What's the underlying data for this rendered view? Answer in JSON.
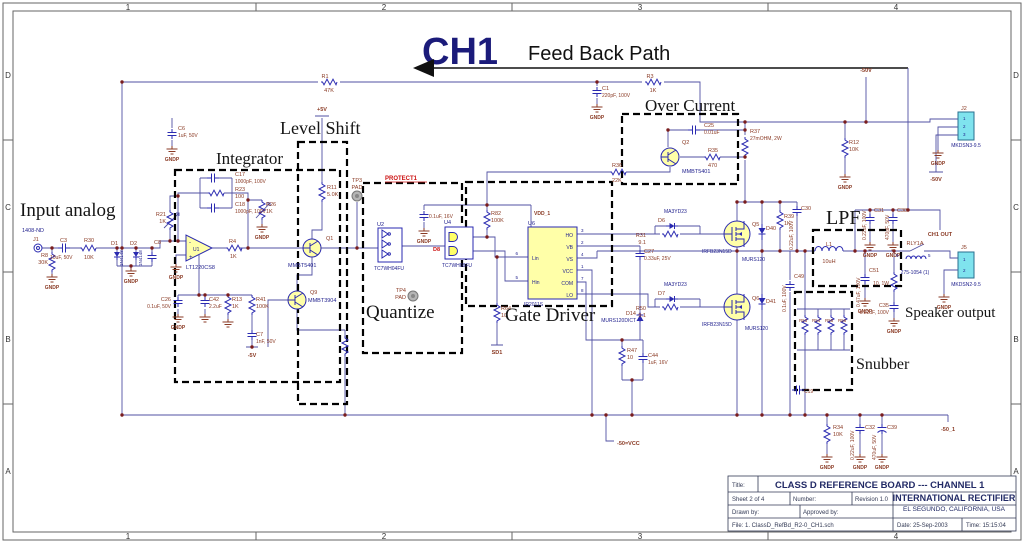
{
  "header": {
    "ch": "CH1",
    "path_label": "Feed Back Path"
  },
  "colors": {
    "component_fill": "#ffffa8",
    "connector_fill": "#7fe3ee",
    "wire": "#5151a3",
    "junction": "#7a1d1d",
    "label_brown": "#8a3a24",
    "label_navy": "#22228e"
  },
  "gnd_label": "GNDP",
  "zones": {
    "cols": [
      "1",
      "2",
      "3",
      "4"
    ],
    "rows": [
      "D",
      "C",
      "B",
      "A"
    ]
  },
  "title_block": {
    "title_label": "Title:",
    "title": "CLASS D REFERENCE BOARD --- CHANNEL 1",
    "sheet": "Sheet  2    of   4",
    "number_label": "Number:",
    "revision": "Revision 1.0",
    "company": "INTERNATIONAL RECTIFIER",
    "address": "EL SEGUNDO, CALIFORNIA, USA",
    "drawn_by": "Drawn by:",
    "approved_by": "Approved by:",
    "file": "File:   1. ClassD_RefBd_R2-0_CH1.sch",
    "date": "Date:  25-Sep-2003",
    "time": "Time:  15:15:04"
  },
  "sections": [
    {
      "id": "input-analog",
      "label": "Input analog",
      "x": 20,
      "y": 216,
      "size": 19
    },
    {
      "id": "integrator",
      "label": "Integrator",
      "x": 216,
      "y": 164,
      "size": 17
    },
    {
      "id": "level-shift",
      "label": "Level Shift",
      "x": 280,
      "y": 134,
      "size": 18
    },
    {
      "id": "quantize",
      "label": "Quantize",
      "x": 366,
      "y": 318,
      "size": 19
    },
    {
      "id": "gate-driver",
      "label": "Gate Driver",
      "x": 505,
      "y": 321,
      "size": 19
    },
    {
      "id": "over-current",
      "label": "Over Current",
      "x": 645,
      "y": 111,
      "size": 17
    },
    {
      "id": "lpf",
      "label": "LPF",
      "x": 826,
      "y": 224,
      "size": 20
    },
    {
      "id": "speaker-output",
      "label": "Speaker output",
      "x": 905,
      "y": 317,
      "size": 15
    },
    {
      "id": "snubber",
      "label": "Snubber",
      "x": 856,
      "y": 369,
      "size": 16
    }
  ],
  "labels": [
    {
      "x": 22,
      "y": 232,
      "t": "1408-ND",
      "c": "part"
    },
    {
      "x": 33,
      "y": 241,
      "t": "J1"
    },
    {
      "x": 48,
      "y": 257,
      "t": "R8",
      "a": "end"
    },
    {
      "x": 48,
      "y": 264,
      "t": "30K",
      "a": "end"
    },
    {
      "x": 60,
      "y": 242,
      "t": "C3"
    },
    {
      "x": 50,
      "y": 259,
      "t": "10uF, 50V",
      "s": 5
    },
    {
      "x": 84,
      "y": 242,
      "t": "R30"
    },
    {
      "x": 84,
      "y": 259,
      "t": "10K"
    },
    {
      "x": 111,
      "y": 245,
      "t": "D1"
    },
    {
      "x": 130,
      "y": 245,
      "t": "D2"
    },
    {
      "x": 123,
      "y": 266,
      "t": "1N4148",
      "c": "part",
      "s": 4.5,
      "r": -90
    },
    {
      "x": 142,
      "y": 266,
      "t": "1N4148",
      "c": "part",
      "s": 4.5,
      "r": -90
    },
    {
      "x": 154,
      "y": 244,
      "t": "C8"
    },
    {
      "x": 178,
      "y": 130,
      "t": "C6"
    },
    {
      "x": 178,
      "y": 137,
      "t": "1uF, 50V",
      "s": 5
    },
    {
      "x": 166,
      "y": 216,
      "t": "R21",
      "a": "end"
    },
    {
      "x": 166,
      "y": 223,
      "t": "1K",
      "a": "end"
    },
    {
      "x": 235,
      "y": 176,
      "t": "C17"
    },
    {
      "x": 235,
      "y": 183,
      "t": "1000pF, 100V",
      "s": 5
    },
    {
      "x": 235,
      "y": 191,
      "t": "R23"
    },
    {
      "x": 235,
      "y": 198,
      "t": "100"
    },
    {
      "x": 235,
      "y": 206,
      "t": "C18"
    },
    {
      "x": 235,
      "y": 213,
      "t": "1000pF, 100V",
      "s": 5
    },
    {
      "x": 266,
      "y": 206,
      "t": "R26"
    },
    {
      "x": 266,
      "y": 213,
      "t": "1K"
    },
    {
      "x": 193,
      "y": 251,
      "t": "U1",
      "c": "part",
      "s": 5
    },
    {
      "x": 186,
      "y": 269,
      "t": "LT1220CS8",
      "c": "part"
    },
    {
      "x": 189,
      "y": 244,
      "t": "-",
      "c": "part",
      "s": 6
    },
    {
      "x": 189,
      "y": 259,
      "t": "+",
      "c": "part",
      "s": 6
    },
    {
      "x": 229,
      "y": 243,
      "t": "R4"
    },
    {
      "x": 230,
      "y": 258,
      "t": "1K"
    },
    {
      "x": 171,
      "y": 301,
      "t": "C26",
      "a": "end"
    },
    {
      "x": 171,
      "y": 308,
      "t": "0.1uF, 50V",
      "a": "end",
      "s": 5
    },
    {
      "x": 209,
      "y": 301,
      "t": "C42"
    },
    {
      "x": 209,
      "y": 308,
      "t": "2.2uF",
      "s": 5
    },
    {
      "x": 232,
      "y": 301,
      "t": "R13"
    },
    {
      "x": 232,
      "y": 308,
      "t": "1K"
    },
    {
      "x": 256,
      "y": 301,
      "t": "R41"
    },
    {
      "x": 256,
      "y": 308,
      "t": "100K"
    },
    {
      "x": 256,
      "y": 336,
      "t": "C7"
    },
    {
      "x": 256,
      "y": 343,
      "t": "1nF, 50V",
      "s": 5
    },
    {
      "x": 252,
      "y": 357,
      "t": "-5V",
      "c": "pwr",
      "a": "middle"
    },
    {
      "x": 322,
      "y": 111,
      "t": "+5V",
      "c": "pwr",
      "a": "middle"
    },
    {
      "x": 327,
      "y": 189,
      "t": "R11"
    },
    {
      "x": 327,
      "y": 196,
      "t": "5.0K"
    },
    {
      "x": 326,
      "y": 240,
      "t": "Q1"
    },
    {
      "x": 288,
      "y": 267,
      "t": "MMBT5401",
      "c": "part"
    },
    {
      "x": 310,
      "y": 294,
      "t": "Q9"
    },
    {
      "x": 308,
      "y": 302,
      "t": "MMBT3904",
      "c": "part"
    },
    {
      "x": 357,
      "y": 182,
      "t": "TP3",
      "a": "middle"
    },
    {
      "x": 357,
      "y": 189,
      "t": "PAD",
      "a": "middle"
    },
    {
      "x": 385,
      "y": 180,
      "t": "PROTECT1",
      "c": "red",
      "s": 6
    },
    {
      "x": 377,
      "y": 226,
      "t": "U2",
      "c": "part"
    },
    {
      "x": 374,
      "y": 270,
      "t": "TC7WH04FU",
      "c": "part",
      "s": 5
    },
    {
      "x": 429,
      "y": 218,
      "t": "0.1uF, 16V",
      "s": 5
    },
    {
      "x": 444,
      "y": 224,
      "t": "U4",
      "c": "part"
    },
    {
      "x": 442,
      "y": 267,
      "t": "TC7WH08FU",
      "c": "part",
      "s": 5
    },
    {
      "x": 440,
      "y": 251,
      "t": "D8",
      "c": "red",
      "a": "end"
    },
    {
      "x": 491,
      "y": 215,
      "t": "R82"
    },
    {
      "x": 491,
      "y": 222,
      "t": "100K"
    },
    {
      "x": 406,
      "y": 292,
      "t": "TP4",
      "a": "end"
    },
    {
      "x": 406,
      "y": 299,
      "t": "PAD",
      "a": "end"
    },
    {
      "x": 501,
      "y": 310,
      "t": "R64"
    },
    {
      "x": 501,
      "y": 317,
      "t": "10"
    },
    {
      "x": 497,
      "y": 354,
      "t": "SD1",
      "c": "pwr",
      "a": "middle"
    },
    {
      "x": 534,
      "y": 215,
      "t": "VDD_1",
      "c": "pwr",
      "s": 5
    },
    {
      "x": 528,
      "y": 225,
      "t": "U6",
      "c": "part"
    },
    {
      "x": 573,
      "y": 237,
      "t": "HO",
      "c": "part",
      "a": "end",
      "s": 5
    },
    {
      "x": 573,
      "y": 249,
      "t": "VB",
      "c": "part",
      "a": "end",
      "s": 5
    },
    {
      "x": 573,
      "y": 261,
      "t": "VS",
      "c": "part",
      "a": "end",
      "s": 5
    },
    {
      "x": 573,
      "y": 273,
      "t": "VCC",
      "c": "part",
      "a": "end",
      "s": 5
    },
    {
      "x": 573,
      "y": 285,
      "t": "COM",
      "c": "part",
      "a": "end",
      "s": 5
    },
    {
      "x": 573,
      "y": 297,
      "t": "LO",
      "c": "part",
      "a": "end",
      "s": 5
    },
    {
      "x": 532,
      "y": 260,
      "t": "Lin",
      "c": "part",
      "s": 5
    },
    {
      "x": 532,
      "y": 284,
      "t": "Hin",
      "c": "part",
      "s": 5
    },
    {
      "x": 581,
      "y": 232,
      "t": "3",
      "c": "pin",
      "s": 4.5
    },
    {
      "x": 581,
      "y": 244,
      "t": "2",
      "c": "pin",
      "s": 4.5
    },
    {
      "x": 581,
      "y": 256,
      "t": "4",
      "c": "pin",
      "s": 4.5
    },
    {
      "x": 581,
      "y": 268,
      "t": "1",
      "c": "pin",
      "s": 4.5
    },
    {
      "x": 581,
      "y": 280,
      "t": "7",
      "c": "pin",
      "s": 4.5
    },
    {
      "x": 581,
      "y": 292,
      "t": "8",
      "c": "pin",
      "s": 4.5
    },
    {
      "x": 518,
      "y": 255,
      "t": "6",
      "c": "pin",
      "a": "end",
      "s": 4.5
    },
    {
      "x": 518,
      "y": 279,
      "t": "5",
      "c": "pin",
      "a": "end",
      "s": 4.5
    },
    {
      "x": 524,
      "y": 306,
      "t": "IR2011S",
      "c": "part",
      "s": 5
    },
    {
      "x": 644,
      "y": 253,
      "t": "C27"
    },
    {
      "x": 644,
      "y": 260,
      "t": "0.33uF, 25V",
      "s": 5
    },
    {
      "x": 636,
      "y": 315,
      "t": "D14",
      "a": "end"
    },
    {
      "x": 636,
      "y": 322,
      "t": "MURS120DICT",
      "c": "part",
      "a": "end",
      "s": 5
    },
    {
      "x": 627,
      "y": 352,
      "t": "R47"
    },
    {
      "x": 627,
      "y": 359,
      "t": "10"
    },
    {
      "x": 648,
      "y": 357,
      "t": "C44"
    },
    {
      "x": 648,
      "y": 364,
      "t": "1uF, 16V",
      "s": 5
    },
    {
      "x": 612,
      "y": 167,
      "t": "R36"
    },
    {
      "x": 612,
      "y": 182,
      "t": "22K"
    },
    {
      "x": 682,
      "y": 144,
      "t": "Q2"
    },
    {
      "x": 682,
      "y": 173,
      "t": "MMBT5401",
      "c": "part"
    },
    {
      "x": 704,
      "y": 127,
      "t": "C25"
    },
    {
      "x": 704,
      "y": 134,
      "t": "0.01uF",
      "s": 5
    },
    {
      "x": 708,
      "y": 152,
      "t": "R35"
    },
    {
      "x": 708,
      "y": 167,
      "t": "470"
    },
    {
      "x": 750,
      "y": 133,
      "t": "R37"
    },
    {
      "x": 750,
      "y": 140,
      "t": "27mOHM, 2W",
      "s": 5
    },
    {
      "x": 664,
      "y": 213,
      "t": "MA3YD23",
      "c": "part",
      "s": 5
    },
    {
      "x": 658,
      "y": 222,
      "t": "D6"
    },
    {
      "x": 646,
      "y": 237,
      "t": "R31",
      "a": "end"
    },
    {
      "x": 646,
      "y": 244,
      "t": "9.1",
      "a": "end"
    },
    {
      "x": 752,
      "y": 226,
      "t": "Q5"
    },
    {
      "x": 702,
      "y": 253,
      "t": "IRFB23N15D",
      "c": "part",
      "s": 5
    },
    {
      "x": 766,
      "y": 230,
      "t": "D40"
    },
    {
      "x": 742,
      "y": 261,
      "t": "MURS120",
      "c": "part",
      "s": 5
    },
    {
      "x": 784,
      "y": 218,
      "t": "R39"
    },
    {
      "x": 784,
      "y": 225,
      "t": "1K"
    },
    {
      "x": 801,
      "y": 210,
      "t": "C30"
    },
    {
      "x": 793,
      "y": 250,
      "t": "0.22uF, 100V",
      "r": -90,
      "s": 5
    },
    {
      "x": 664,
      "y": 286,
      "t": "MA3YD23",
      "c": "part",
      "s": 5
    },
    {
      "x": 658,
      "y": 295,
      "t": "D7"
    },
    {
      "x": 646,
      "y": 310,
      "t": "R50",
      "a": "end"
    },
    {
      "x": 646,
      "y": 317,
      "t": "9.1",
      "a": "end"
    },
    {
      "x": 752,
      "y": 300,
      "t": "Q6"
    },
    {
      "x": 702,
      "y": 326,
      "t": "IRFB23N15D",
      "c": "part",
      "s": 5
    },
    {
      "x": 766,
      "y": 303,
      "t": "D41"
    },
    {
      "x": 745,
      "y": 330,
      "t": "MURS120",
      "c": "part",
      "s": 5
    },
    {
      "x": 794,
      "y": 278,
      "t": "C49"
    },
    {
      "x": 786,
      "y": 312,
      "t": "0.1uF, 100V",
      "r": -90,
      "s": 5
    },
    {
      "x": 829,
      "y": 246,
      "t": "L1",
      "a": "middle"
    },
    {
      "x": 829,
      "y": 263,
      "t": "10uH",
      "a": "middle"
    },
    {
      "x": 869,
      "y": 272,
      "t": "C51"
    },
    {
      "x": 860,
      "y": 307,
      "t": "0.47uF, 100V",
      "r": -90,
      "s": 5
    },
    {
      "x": 889,
      "y": 285,
      "t": "10, 1W",
      "a": "end",
      "s": 5
    },
    {
      "x": 889,
      "y": 307,
      "t": "C35",
      "a": "end"
    },
    {
      "x": 889,
      "y": 314,
      "t": "0.22uF, 100V",
      "a": "end",
      "s": 5
    },
    {
      "x": 874,
      "y": 212,
      "t": "C31"
    },
    {
      "x": 866,
      "y": 240,
      "t": "0.22uF, 100V",
      "r": -90,
      "s": 5
    },
    {
      "x": 897,
      "y": 212,
      "t": "C38"
    },
    {
      "x": 889,
      "y": 240,
      "t": "470pF, 50V",
      "r": -90,
      "s": 5
    },
    {
      "x": 940,
      "y": 236,
      "t": "CH1 OUT",
      "c": "pwr",
      "a": "middle",
      "s": 5.5
    },
    {
      "x": 915,
      "y": 245,
      "t": "RLY1A",
      "a": "middle"
    },
    {
      "x": 915,
      "y": 274,
      "t": "275-1054 (1)",
      "c": "part",
      "a": "middle",
      "s": 5
    },
    {
      "x": 896,
      "y": 257,
      "t": "8",
      "c": "pin",
      "s": 4.5
    },
    {
      "x": 928,
      "y": 257,
      "t": "5",
      "c": "pin",
      "s": 4.5
    },
    {
      "x": 961,
      "y": 249,
      "t": "J5"
    },
    {
      "x": 966,
      "y": 286,
      "t": "MKDSN2-9.5",
      "c": "part",
      "a": "middle",
      "s": 5
    },
    {
      "x": 961,
      "y": 110,
      "t": "J2"
    },
    {
      "x": 966,
      "y": 147,
      "t": "MKDSN3-9.5",
      "c": "part",
      "a": "middle",
      "s": 5
    },
    {
      "x": 963,
      "y": 120,
      "t": "1",
      "c": "pin",
      "s": 4.5
    },
    {
      "x": 963,
      "y": 128,
      "t": "2",
      "c": "pin",
      "s": 4.5
    },
    {
      "x": 963,
      "y": 136,
      "t": "3",
      "c": "pin",
      "s": 4.5
    },
    {
      "x": 963,
      "y": 261,
      "t": "1",
      "c": "pin",
      "s": 4.5
    },
    {
      "x": 963,
      "y": 272,
      "t": "2",
      "c": "pin",
      "s": 4.5
    },
    {
      "x": 866,
      "y": 72,
      "t": "-50V",
      "c": "pwr",
      "a": "middle"
    },
    {
      "x": 936,
      "y": 181,
      "t": "-50V",
      "c": "pwr",
      "a": "middle"
    },
    {
      "x": 849,
      "y": 144,
      "t": "R12"
    },
    {
      "x": 849,
      "y": 151,
      "t": "10K"
    },
    {
      "x": 325,
      "y": 78,
      "t": "R1",
      "a": "middle"
    },
    {
      "x": 329,
      "y": 92,
      "t": "47K",
      "a": "middle"
    },
    {
      "x": 650,
      "y": 78,
      "t": "R3",
      "a": "middle"
    },
    {
      "x": 653,
      "y": 92,
      "t": "1K",
      "a": "middle"
    },
    {
      "x": 602,
      "y": 90,
      "t": "C1"
    },
    {
      "x": 602,
      "y": 97,
      "t": "220pF, 100V",
      "s": 5
    },
    {
      "x": 799,
      "y": 322,
      "t": "R53",
      "s": 4.5
    },
    {
      "x": 812,
      "y": 322,
      "t": "R54",
      "s": 4.5
    },
    {
      "x": 825,
      "y": 322,
      "t": "R55",
      "s": 4.5
    },
    {
      "x": 838,
      "y": 322,
      "t": "R56",
      "s": 4.5
    },
    {
      "x": 804,
      "y": 393,
      "t": "C19",
      "s": 5
    },
    {
      "x": 833,
      "y": 429,
      "t": "R34"
    },
    {
      "x": 833,
      "y": 436,
      "t": "10K"
    },
    {
      "x": 865,
      "y": 429,
      "t": "C32"
    },
    {
      "x": 854,
      "y": 460,
      "t": "0.22uF, 100V",
      "r": -90,
      "s": 5
    },
    {
      "x": 887,
      "y": 429,
      "t": "C39"
    },
    {
      "x": 876,
      "y": 460,
      "t": "470uF, 50V",
      "r": -90,
      "s": 5
    },
    {
      "x": 948,
      "y": 431,
      "t": "-50_1",
      "c": "pwr",
      "a": "middle"
    },
    {
      "x": 617,
      "y": 445,
      "t": "-50=VCC",
      "c": "pwr",
      "s": 5.5
    }
  ],
  "grounds": [
    [
      52,
      274
    ],
    [
      131,
      268
    ],
    [
      176,
      264
    ],
    [
      178,
      314
    ],
    [
      205,
      314,
      1
    ],
    [
      228,
      319,
      1
    ],
    [
      262,
      224
    ],
    [
      424,
      228
    ],
    [
      597,
      104
    ],
    [
      172,
      146
    ],
    [
      845,
      174
    ],
    [
      938,
      150
    ],
    [
      870,
      242
    ],
    [
      893,
      242
    ],
    [
      865,
      298
    ],
    [
      894,
      318
    ],
    [
      944,
      294
    ],
    [
      827,
      454
    ],
    [
      860,
      454
    ],
    [
      882,
      454
    ]
  ],
  "junctions": [
    [
      122,
      82
    ],
    [
      122,
      248
    ],
    [
      122,
      415
    ],
    [
      52,
      248
    ],
    [
      117,
      248
    ],
    [
      136,
      248
    ],
    [
      152,
      248
    ],
    [
      131,
      266
    ],
    [
      170,
      241
    ],
    [
      178,
      241
    ],
    [
      178,
      196
    ],
    [
      248,
      200
    ],
    [
      248,
      248
    ],
    [
      199,
      295
    ],
    [
      205,
      295
    ],
    [
      228,
      295
    ],
    [
      252,
      347
    ],
    [
      357,
      248
    ],
    [
      487,
      205
    ],
    [
      487,
      237
    ],
    [
      497,
      257
    ],
    [
      597,
      82
    ],
    [
      622,
      340
    ],
    [
      632,
      380
    ],
    [
      668,
      130
    ],
    [
      745,
      130
    ],
    [
      745,
      157
    ],
    [
      745,
      122
    ],
    [
      845,
      122
    ],
    [
      866,
      122
    ],
    [
      737,
      202
    ],
    [
      745,
      202
    ],
    [
      762,
      202
    ],
    [
      780,
      202
    ],
    [
      737,
      251
    ],
    [
      762,
      251
    ],
    [
      780,
      251
    ],
    [
      797,
      251
    ],
    [
      805,
      251
    ],
    [
      855,
      251
    ],
    [
      865,
      251
    ],
    [
      894,
      251
    ],
    [
      870,
      210
    ],
    [
      893,
      210
    ],
    [
      908,
      210
    ],
    [
      345,
      415
    ],
    [
      592,
      415
    ],
    [
      606,
      415
    ],
    [
      632,
      415
    ],
    [
      737,
      415
    ],
    [
      762,
      415
    ],
    [
      790,
      415
    ],
    [
      805,
      415
    ],
    [
      827,
      415
    ],
    [
      860,
      415
    ],
    [
      882,
      415
    ]
  ]
}
